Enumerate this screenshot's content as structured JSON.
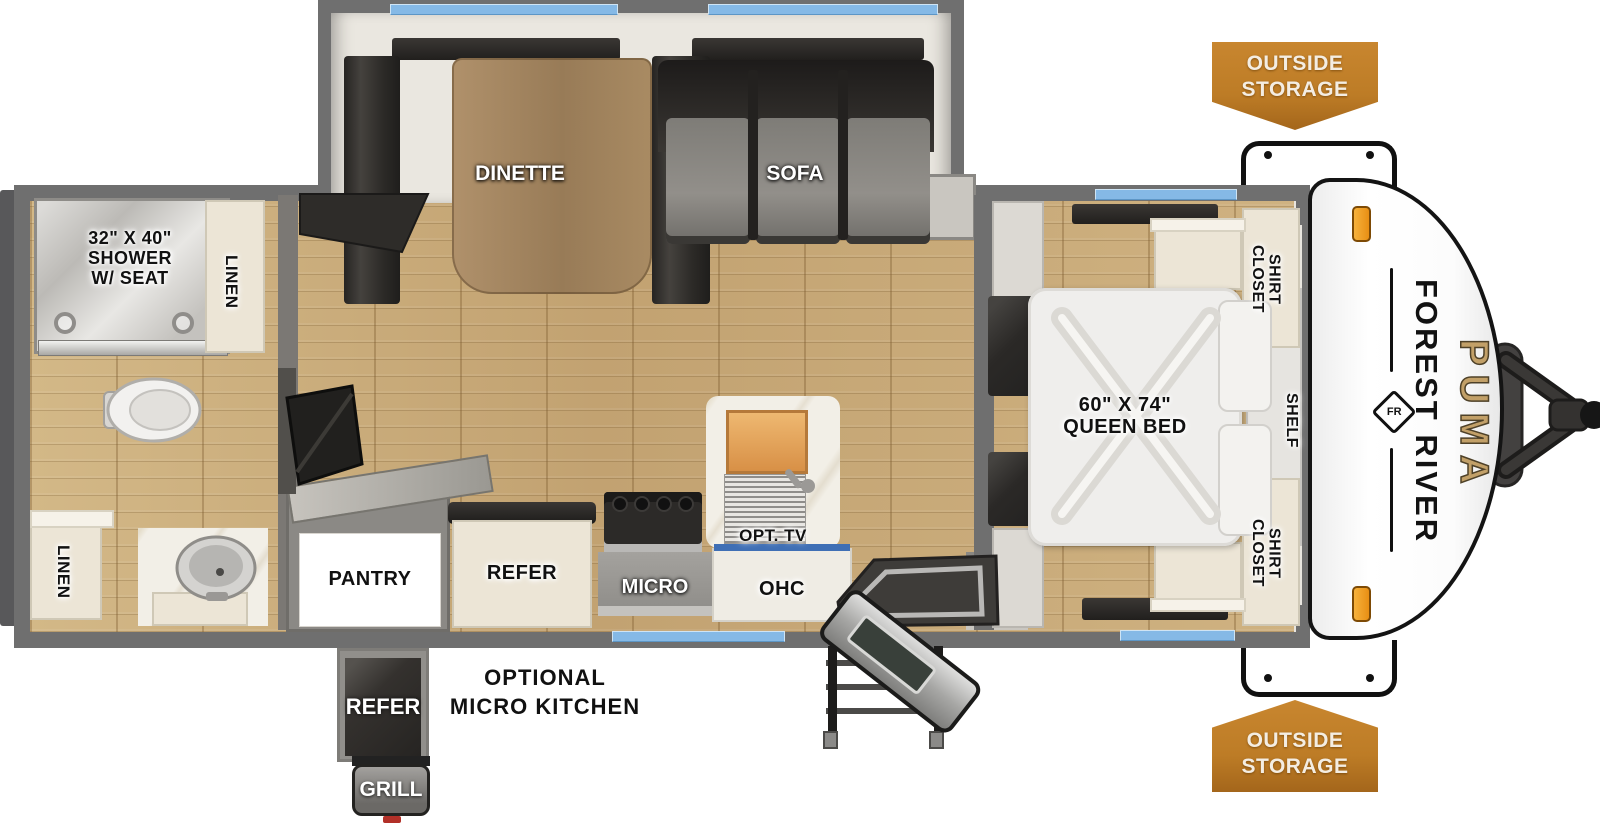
{
  "brand": {
    "manufacturer": "FOREST RIVER",
    "model": "PUMA",
    "logo_monogram": "FR"
  },
  "badges": {
    "outside_storage_top": "OUTSIDE\nSTORAGE",
    "outside_storage_bottom": "OUTSIDE\nSTORAGE"
  },
  "bathroom": {
    "shower": "32\" X 40\"\nSHOWER\nW/ SEAT",
    "linen_top": "LINEN",
    "linen_bottom": "LINEN"
  },
  "living": {
    "dinette": "DINETTE",
    "sofa": "SOFA"
  },
  "kitchen": {
    "pantry": "PANTRY",
    "refer": "REFER",
    "micro": "MICRO",
    "ohc": "OHC",
    "opt_tv": "OPT. TV"
  },
  "bedroom": {
    "bed": "60\" X 74\"\nQUEEN BED",
    "shirt_closet_top": "SHIRT\nCLOSET",
    "shelf": "SHELF",
    "shirt_closet_bottom": "SHIRT\nCLOSET"
  },
  "optional_micro_kitchen": {
    "title": "OPTIONAL\nMICRO KITCHEN",
    "refer": "REFER",
    "grill": "GRILL"
  },
  "colors": {
    "wall_gray": "#6f6f6f",
    "floor_wood": "#c9ac7d",
    "window_blue": "#85b9e6",
    "badge_orange": "#bd7c26",
    "brand_gold": "#c2a068",
    "cap_white": "#fcfcfc"
  }
}
